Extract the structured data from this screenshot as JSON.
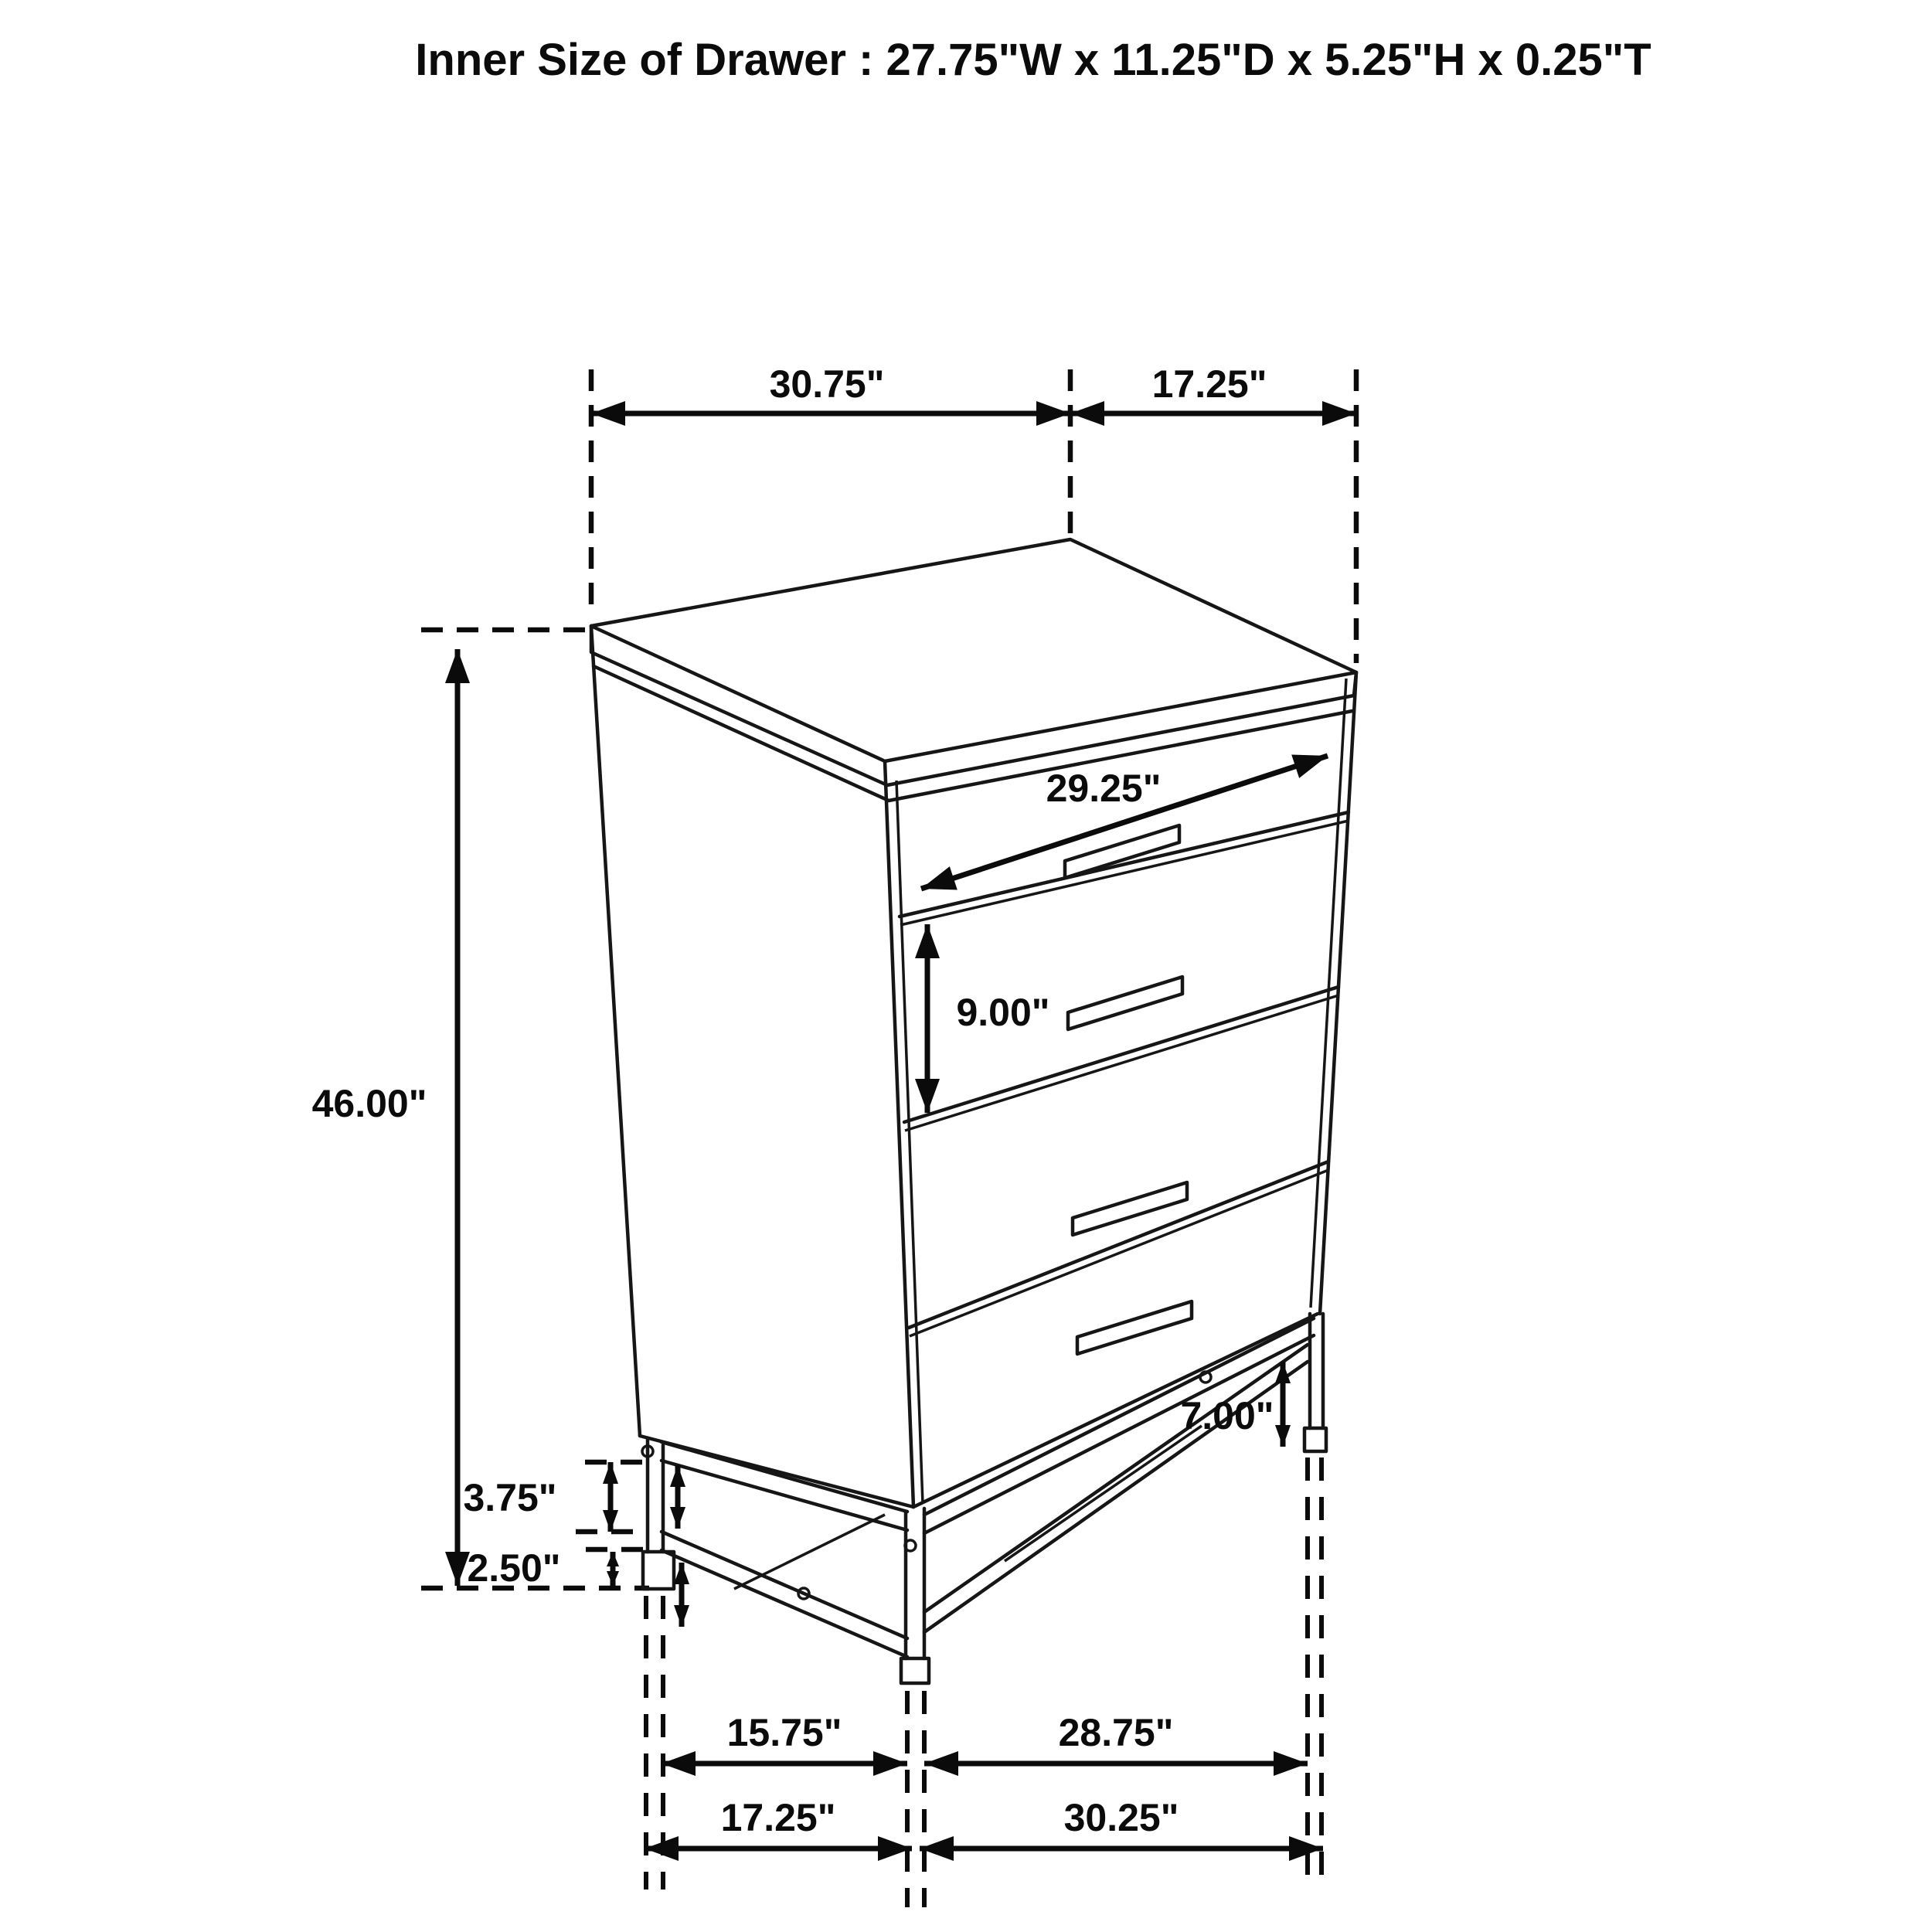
{
  "title": "Inner Size of Drawer : 27.75\"W x 11.25\"D x 5.25\"H x 0.25\"T",
  "dims": {
    "top_width": "30.75\"",
    "top_depth": "17.25\"",
    "drawer_width": "29.25\"",
    "drawer_height": "9.00\"",
    "overall_height": "46.00\"",
    "leg_clearance": "7.00\"",
    "rail_gap": "3.75\"",
    "foot_height": "2.50\"",
    "base_inner_depth": "15.75\"",
    "base_inner_width": "28.75\"",
    "base_outer_depth": "17.25\"",
    "base_outer_width": "30.25\""
  }
}
